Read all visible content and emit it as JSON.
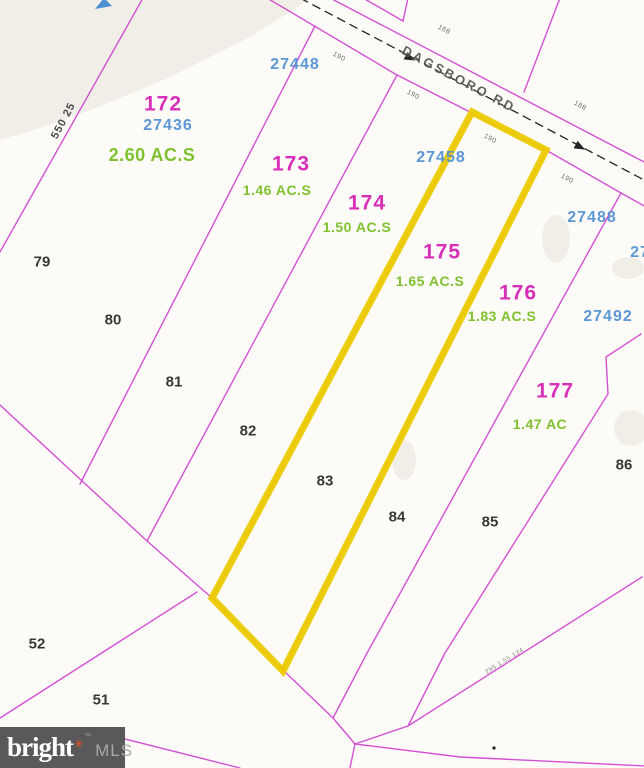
{
  "map": {
    "type": "plat-parcel-map",
    "road": {
      "name": "DAGSBORO RD"
    },
    "highlight": {
      "parcel": "175",
      "color": "#eccb00"
    },
    "colors": {
      "parcel_line": "#cf3fcf",
      "parcel_number": "#d72fb8",
      "apn_number": "#4f8fd4",
      "acreage": "#7fc12e",
      "highlight": "#eccb00"
    },
    "labels": [
      {
        "name": "survey-dim-550-25",
        "text": "550 25",
        "x": 64,
        "y": 121,
        "cls": "survey",
        "rot": -62
      },
      {
        "name": "parcel-id-172",
        "text": "172",
        "x": 163,
        "y": 104,
        "cls": "parcel"
      },
      {
        "name": "apn-27436",
        "text": "27436",
        "x": 168,
        "y": 126,
        "cls": "apn"
      },
      {
        "name": "acreage-172",
        "text": "2.60 AC.S",
        "x": 152,
        "y": 155,
        "cls": "acre acre-lg"
      },
      {
        "name": "apn-27448",
        "text": "27448",
        "x": 295,
        "y": 65,
        "cls": "apn"
      },
      {
        "name": "parcel-id-173",
        "text": "173",
        "x": 291,
        "y": 164,
        "cls": "parcel"
      },
      {
        "name": "acreage-173",
        "text": "1.46 AC.S",
        "x": 277,
        "y": 190,
        "cls": "acre"
      },
      {
        "name": "parcel-id-174",
        "text": "174",
        "x": 367,
        "y": 203,
        "cls": "parcel"
      },
      {
        "name": "acreage-174",
        "text": "1.50 AC.S",
        "x": 357,
        "y": 227,
        "cls": "acre"
      },
      {
        "name": "apn-27458",
        "text": "27458",
        "x": 441,
        "y": 158,
        "cls": "apn"
      },
      {
        "name": "parcel-id-175",
        "text": "175",
        "x": 442,
        "y": 252,
        "cls": "parcel"
      },
      {
        "name": "acreage-175",
        "text": "1.65 AC.S",
        "x": 430,
        "y": 281,
        "cls": "acre"
      },
      {
        "name": "parcel-id-176",
        "text": "176",
        "x": 518,
        "y": 293,
        "cls": "parcel"
      },
      {
        "name": "acreage-176",
        "text": "1.83 AC.S",
        "x": 502,
        "y": 316,
        "cls": "acre"
      },
      {
        "name": "apn-27488",
        "text": "27488",
        "x": 592,
        "y": 218,
        "cls": "apn"
      },
      {
        "name": "apn-27492",
        "text": "27492",
        "x": 608,
        "y": 317,
        "cls": "apn"
      },
      {
        "name": "apn-274xx-clipped",
        "text": "27",
        "x": 640,
        "y": 253,
        "cls": "apn"
      },
      {
        "name": "apn-clipped-left",
        "text": "9",
        "x": -5,
        "y": 179,
        "cls": "apn"
      },
      {
        "name": "parcel-id-177",
        "text": "177",
        "x": 555,
        "y": 391,
        "cls": "parcel"
      },
      {
        "name": "acreage-177",
        "text": "1.47 AC",
        "x": 540,
        "y": 424,
        "cls": "acre"
      },
      {
        "name": "lot-79",
        "text": "79",
        "x": 42,
        "y": 262,
        "cls": "lot"
      },
      {
        "name": "lot-80",
        "text": "80",
        "x": 113,
        "y": 320,
        "cls": "lot"
      },
      {
        "name": "lot-81",
        "text": "81",
        "x": 174,
        "y": 382,
        "cls": "lot"
      },
      {
        "name": "lot-82",
        "text": "82",
        "x": 248,
        "y": 431,
        "cls": "lot"
      },
      {
        "name": "lot-83",
        "text": "83",
        "x": 325,
        "y": 481,
        "cls": "lot"
      },
      {
        "name": "lot-84",
        "text": "84",
        "x": 397,
        "y": 517,
        "cls": "lot"
      },
      {
        "name": "lot-85",
        "text": "85",
        "x": 490,
        "y": 522,
        "cls": "lot"
      },
      {
        "name": "lot-86",
        "text": "86",
        "x": 624,
        "y": 465,
        "cls": "lot"
      },
      {
        "name": "lot-52",
        "text": "52",
        "x": 37,
        "y": 644,
        "cls": "lot"
      },
      {
        "name": "lot-51",
        "text": "51",
        "x": 101,
        "y": 700,
        "cls": "lot"
      },
      {
        "name": "road-name-label",
        "text": "DAGSBORO RD",
        "x": 459,
        "y": 79,
        "cls": "road",
        "rot": 28
      },
      {
        "name": "road-dim-168",
        "text": "168",
        "x": 444,
        "y": 30,
        "cls": "dim",
        "rot": 28
      },
      {
        "name": "road-dim-190-a",
        "text": "190",
        "x": 339,
        "y": 57,
        "cls": "dim",
        "rot": 28
      },
      {
        "name": "road-dim-190-b",
        "text": "190",
        "x": 413,
        "y": 95,
        "cls": "dim",
        "rot": 28
      },
      {
        "name": "road-dim-188",
        "text": "188",
        "x": 580,
        "y": 106,
        "cls": "dim",
        "rot": 28
      },
      {
        "name": "road-dim-190-c",
        "text": "190",
        "x": 490,
        "y": 139,
        "cls": "dim",
        "rot": 28
      },
      {
        "name": "road-dim-190-d",
        "text": "190",
        "x": 567,
        "y": 179,
        "cls": "dim",
        "rot": 28
      },
      {
        "name": "deed-reference",
        "text": "295 1.55 134",
        "x": 505,
        "y": 662,
        "cls": "deed",
        "rot": -32
      }
    ],
    "watermark": {
      "brand": "bright",
      "star": "✳",
      "tm": "™",
      "suffix": "MLS"
    }
  }
}
